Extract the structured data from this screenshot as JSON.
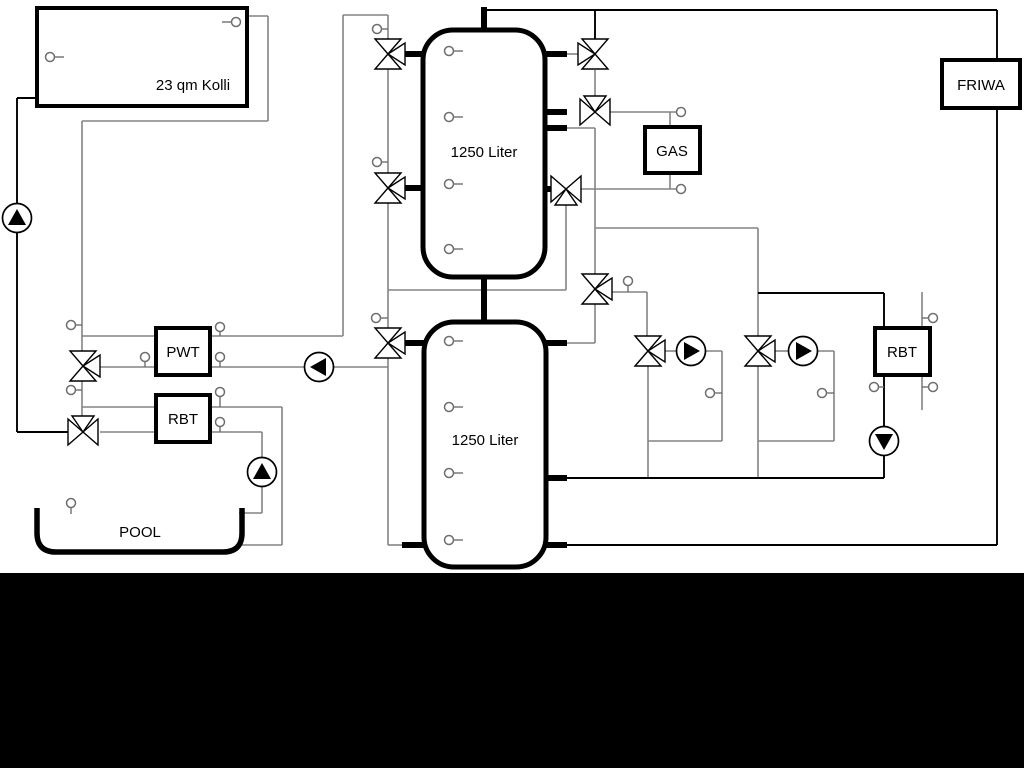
{
  "meta": {
    "kind": "hydraulic-schematic"
  },
  "labels": {
    "collector": "23 qm Kolli",
    "tank1": "1250 Liter",
    "tank2": "1250 Liter",
    "gas": "GAS",
    "friwa": "FRIWA",
    "pwt": "PWT",
    "rbt_left": "RBT",
    "rbt_right": "RBT",
    "pool": "POOL"
  },
  "colors": {
    "pipe_gray": "#838383",
    "pipe_black": "#000000",
    "stub_black": "#000000",
    "box_stroke": "#000000",
    "box_fill": "#ffffff",
    "sensor_stroke": "#6e6e6e",
    "band": "#000000"
  },
  "canvas": {
    "w": 1024,
    "h": 768
  },
  "footer_band": {
    "x": 0,
    "y": 573,
    "w": 1024,
    "h": 195
  },
  "pipes": {
    "gray": [
      [
        248,
        16,
        268,
        16
      ],
      [
        268,
        16,
        268,
        121
      ],
      [
        268,
        121,
        82,
        121
      ],
      [
        82,
        121,
        82,
        351
      ],
      [
        82,
        336,
        343,
        336
      ],
      [
        343,
        336,
        343,
        15
      ],
      [
        343,
        15,
        388,
        15
      ],
      [
        388,
        15,
        388,
        40
      ],
      [
        100,
        367,
        388,
        367
      ],
      [
        82,
        381,
        82,
        418
      ],
      [
        82,
        407,
        282,
        407
      ],
      [
        282,
        407,
        282,
        545
      ],
      [
        282,
        545,
        242,
        545
      ],
      [
        100,
        432,
        262,
        432
      ],
      [
        262,
        432,
        262,
        458
      ],
      [
        262,
        486,
        262,
        513
      ],
      [
        262,
        513,
        239,
        513
      ],
      [
        388,
        69,
        388,
        173
      ],
      [
        388,
        203,
        388,
        328
      ],
      [
        388,
        358,
        388,
        545
      ],
      [
        388,
        545,
        404,
        545
      ],
      [
        388,
        290,
        566,
        290
      ],
      [
        566,
        290,
        566,
        204
      ],
      [
        581,
        189,
        677,
        189
      ],
      [
        670,
        173,
        670,
        189
      ],
      [
        610,
        112,
        677,
        112
      ],
      [
        670,
        127,
        670,
        112
      ],
      [
        566,
        54,
        578,
        54
      ],
      [
        595,
        70,
        595,
        96
      ],
      [
        566,
        128,
        595,
        128
      ],
      [
        595,
        128,
        595,
        274
      ],
      [
        595,
        228,
        758,
        228
      ],
      [
        758,
        228,
        758,
        336
      ],
      [
        612,
        292,
        647,
        292
      ],
      [
        647,
        292,
        647,
        336
      ],
      [
        595,
        304,
        595,
        343
      ],
      [
        595,
        343,
        566,
        343
      ],
      [
        648,
        366,
        648,
        478
      ],
      [
        665,
        351,
        677,
        351
      ],
      [
        705,
        351,
        722,
        351
      ],
      [
        722,
        351,
        722,
        441
      ],
      [
        722,
        441,
        648,
        441
      ],
      [
        775,
        351,
        789,
        351
      ],
      [
        817,
        351,
        834,
        351
      ],
      [
        834,
        351,
        834,
        441
      ],
      [
        834,
        441,
        758,
        441
      ],
      [
        758,
        366,
        758,
        478
      ],
      [
        922,
        292,
        922,
        410
      ]
    ],
    "black": [
      [
        37,
        98,
        17,
        98
      ],
      [
        17,
        98,
        17,
        204
      ],
      [
        17,
        232,
        17,
        432
      ],
      [
        17,
        432,
        68,
        432
      ],
      [
        484,
        10,
        997,
        10
      ],
      [
        595,
        10,
        595,
        39
      ],
      [
        997,
        10,
        997,
        60
      ],
      [
        997,
        108,
        997,
        545
      ],
      [
        997,
        545,
        566,
        545
      ],
      [
        566,
        478,
        884,
        478
      ],
      [
        884,
        478,
        884,
        456
      ],
      [
        884,
        427,
        884,
        375
      ],
      [
        884,
        328,
        884,
        293
      ],
      [
        884,
        293,
        758,
        293
      ]
    ],
    "stubs": [
      [
        484,
        7,
        484,
        31
      ],
      [
        484,
        276,
        484,
        323
      ],
      [
        403,
        54,
        424,
        54
      ],
      [
        403,
        188,
        424,
        188
      ],
      [
        403,
        343,
        424,
        343
      ],
      [
        402,
        545,
        424,
        545
      ],
      [
        545,
        54,
        567,
        54
      ],
      [
        545,
        112,
        567,
        112
      ],
      [
        545,
        128,
        567,
        128
      ],
      [
        545,
        189,
        551,
        189
      ],
      [
        546,
        343,
        567,
        343
      ],
      [
        546,
        478,
        567,
        478
      ],
      [
        546,
        545,
        567,
        545
      ]
    ]
  },
  "boxes": [
    {
      "id": "collector",
      "x": 37,
      "y": 8,
      "w": 210,
      "h": 98,
      "rx": 0,
      "sw": 4,
      "name": "solar-collector-box"
    },
    {
      "id": "tank1",
      "x": 423,
      "y": 30,
      "w": 122,
      "h": 247,
      "rx": 30,
      "sw": 5,
      "name": "buffer-tank-1"
    },
    {
      "id": "tank2",
      "x": 424,
      "y": 322,
      "w": 122,
      "h": 245,
      "rx": 30,
      "sw": 5,
      "name": "buffer-tank-2"
    },
    {
      "id": "gas",
      "x": 645,
      "y": 127,
      "w": 55,
      "h": 46,
      "rx": 0,
      "sw": 4,
      "name": "gas-boiler-box"
    },
    {
      "id": "friwa",
      "x": 942,
      "y": 60,
      "w": 78,
      "h": 48,
      "rx": 0,
      "sw": 4,
      "name": "friwa-station-box"
    },
    {
      "id": "pwt",
      "x": 156,
      "y": 328,
      "w": 54,
      "h": 47,
      "rx": 0,
      "sw": 4,
      "name": "pwt-heat-exchanger-box"
    },
    {
      "id": "rbt_left",
      "x": 156,
      "y": 395,
      "w": 54,
      "h": 47,
      "rx": 0,
      "sw": 4,
      "name": "rbt-heat-exchanger-left-box"
    },
    {
      "id": "rbt_right",
      "x": 875,
      "y": 328,
      "w": 55,
      "h": 47,
      "rx": 0,
      "sw": 4,
      "name": "rbt-heat-exchanger-right-box"
    }
  ],
  "pool": {
    "x1": 37,
    "x2": 242,
    "top": 508,
    "bottom": 552,
    "corner": 19,
    "sw": 5.5,
    "name": "pool-basin"
  },
  "valves": [
    {
      "cx": 388,
      "cy": 54,
      "axis": "v",
      "port": "right",
      "name": "three-way-valve-tank1-top-left"
    },
    {
      "cx": 388,
      "cy": 188,
      "axis": "v",
      "port": "right",
      "name": "three-way-valve-tank1-mid-left"
    },
    {
      "cx": 388,
      "cy": 343,
      "axis": "v",
      "port": "right",
      "name": "three-way-valve-tank2-left"
    },
    {
      "cx": 595,
      "cy": 54,
      "axis": "v",
      "port": "left",
      "name": "three-way-valve-tank1-top-right"
    },
    {
      "cx": 595,
      "cy": 112,
      "axis": "h",
      "port": "up",
      "name": "three-way-valve-gas-supply"
    },
    {
      "cx": 566,
      "cy": 189,
      "axis": "h",
      "port": "down",
      "name": "three-way-valve-gas-return"
    },
    {
      "cx": 595,
      "cy": 289,
      "axis": "v",
      "port": "right",
      "name": "three-way-valve-distribution"
    },
    {
      "cx": 648,
      "cy": 351,
      "axis": "v",
      "port": "right",
      "name": "three-way-valve-circuit-1"
    },
    {
      "cx": 758,
      "cy": 351,
      "axis": "v",
      "port": "right",
      "name": "three-way-valve-circuit-2"
    },
    {
      "cx": 83,
      "cy": 366,
      "axis": "v",
      "port": "right",
      "name": "three-way-valve-pwt"
    },
    {
      "cx": 83,
      "cy": 432,
      "axis": "h",
      "port": "up",
      "name": "three-way-valve-pool"
    }
  ],
  "pumps": [
    {
      "cx": 17,
      "cy": 218,
      "dir": "up",
      "name": "pump-solar"
    },
    {
      "cx": 319,
      "cy": 367,
      "dir": "left",
      "name": "pump-pwt-charge"
    },
    {
      "cx": 262,
      "cy": 472,
      "dir": "up",
      "name": "pump-pool"
    },
    {
      "cx": 691,
      "cy": 351,
      "dir": "right",
      "name": "pump-circuit-1"
    },
    {
      "cx": 803,
      "cy": 351,
      "dir": "right",
      "name": "pump-circuit-2"
    },
    {
      "cx": 884,
      "cy": 441,
      "dir": "down",
      "name": "pump-rbt-right"
    }
  ],
  "sensors": [
    {
      "cx": 50,
      "cy": 57,
      "tick": [
        55,
        57,
        64,
        57
      ]
    },
    {
      "cx": 236,
      "cy": 22,
      "tick": [
        231,
        22,
        222,
        22
      ]
    },
    {
      "cx": 377,
      "cy": 29,
      "tick": [
        382,
        29,
        388,
        29
      ]
    },
    {
      "cx": 377,
      "cy": 162,
      "tick": [
        382,
        162,
        388,
        162
      ]
    },
    {
      "cx": 376,
      "cy": 318,
      "tick": [
        381,
        318,
        388,
        318
      ]
    },
    {
      "cx": 71,
      "cy": 325,
      "tick": [
        76,
        325,
        82,
        325
      ]
    },
    {
      "cx": 71,
      "cy": 390,
      "tick": [
        76,
        390,
        82,
        390
      ]
    },
    {
      "cx": 145,
      "cy": 357,
      "tick": [
        145,
        362,
        145,
        367
      ]
    },
    {
      "cx": 220,
      "cy": 327,
      "tick": [
        220,
        332,
        220,
        336
      ]
    },
    {
      "cx": 220,
      "cy": 357,
      "tick": [
        220,
        362,
        220,
        367
      ]
    },
    {
      "cx": 220,
      "cy": 392,
      "tick": [
        220,
        397,
        220,
        407
      ]
    },
    {
      "cx": 220,
      "cy": 422,
      "tick": [
        220,
        427,
        220,
        432
      ]
    },
    {
      "cx": 71,
      "cy": 503,
      "tick": [
        71,
        508,
        71,
        514
      ]
    },
    {
      "cx": 681,
      "cy": 112,
      "tick": null
    },
    {
      "cx": 681,
      "cy": 189,
      "tick": null
    },
    {
      "cx": 628,
      "cy": 281,
      "tick": [
        628,
        286,
        628,
        292
      ]
    },
    {
      "cx": 710,
      "cy": 393,
      "tick": [
        715,
        393,
        722,
        393
      ]
    },
    {
      "cx": 822,
      "cy": 393,
      "tick": [
        827,
        393,
        834,
        393
      ]
    },
    {
      "cx": 874,
      "cy": 387,
      "tick": [
        879,
        387,
        884,
        387
      ]
    },
    {
      "cx": 933,
      "cy": 318,
      "tick": [
        928,
        318,
        922,
        318
      ]
    },
    {
      "cx": 933,
      "cy": 387,
      "tick": [
        928,
        387,
        922,
        387
      ]
    }
  ],
  "tank_ports": [
    {
      "cx": 449,
      "cy": 51
    },
    {
      "cx": 449,
      "cy": 117
    },
    {
      "cx": 449,
      "cy": 184
    },
    {
      "cx": 449,
      "cy": 249
    },
    {
      "cx": 449,
      "cy": 341
    },
    {
      "cx": 449,
      "cy": 407
    },
    {
      "cx": 449,
      "cy": 473
    },
    {
      "cx": 449,
      "cy": 540
    }
  ],
  "label_pos": [
    {
      "key": "collector",
      "x": 193,
      "y": 90,
      "size": 15
    },
    {
      "key": "tank1",
      "x": 484,
      "y": 157,
      "size": 15
    },
    {
      "key": "tank2",
      "x": 485,
      "y": 445,
      "size": 15
    },
    {
      "key": "gas",
      "x": 672,
      "y": 156,
      "size": 15
    },
    {
      "key": "friwa",
      "x": 981,
      "y": 90,
      "size": 15
    },
    {
      "key": "pwt",
      "x": 183,
      "y": 357,
      "size": 15
    },
    {
      "key": "rbt_left",
      "x": 183,
      "y": 424,
      "size": 15
    },
    {
      "key": "rbt_right",
      "x": 902,
      "y": 357,
      "size": 15
    },
    {
      "key": "pool",
      "x": 140,
      "y": 537,
      "size": 15
    }
  ]
}
